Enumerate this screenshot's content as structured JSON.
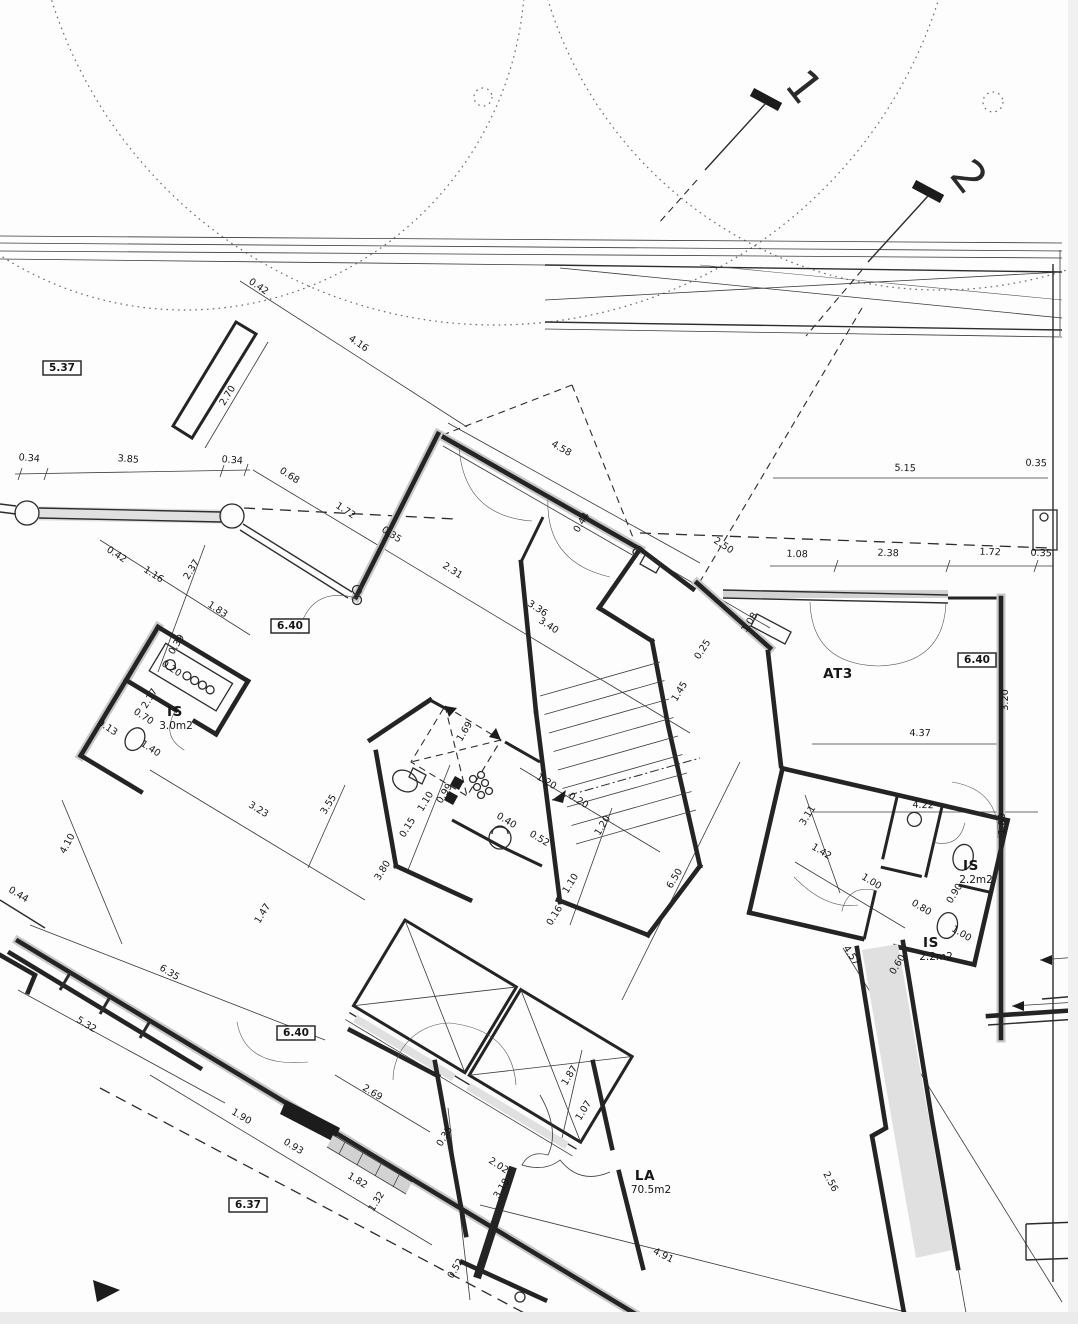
{
  "meta": {
    "kind": "architectural-floor-plan-scan",
    "units": "m"
  },
  "rooms": [
    {
      "name": "AT3",
      "area": ""
    },
    {
      "name": "IS",
      "area": "3.0m2"
    },
    {
      "name": "IS",
      "area": "2.2m2"
    },
    {
      "name": "IS",
      "area": "2.2m2"
    },
    {
      "name": "LA",
      "area": "70.5m2"
    }
  ],
  "elevation_marks": [
    "5.37",
    "6.40",
    "6.40",
    "6.40",
    "6.37"
  ],
  "section_markers": [
    "1",
    "2"
  ],
  "labels": [
    {
      "t": "1",
      "x": 792,
      "y": 96,
      "r": 52,
      "s": "big"
    },
    {
      "t": "2",
      "x": 957,
      "y": 186,
      "r": 52,
      "s": "big"
    },
    {
      "t": "0.42",
      "x": 257,
      "y": 289,
      "r": 34,
      "s": "dim"
    },
    {
      "t": "4.16",
      "x": 357,
      "y": 346,
      "r": 34,
      "s": "dim"
    },
    {
      "t": "2.70",
      "x": 230,
      "y": 397,
      "r": -58,
      "s": "dim"
    },
    {
      "t": "5.37",
      "x": 62,
      "y": 371,
      "r": 0,
      "s": "box"
    },
    {
      "t": "0.34",
      "x": 29,
      "y": 461,
      "r": 5,
      "s": "dim"
    },
    {
      "t": "3.85",
      "x": 128,
      "y": 462,
      "r": 5,
      "s": "dim"
    },
    {
      "t": "0.34",
      "x": 232,
      "y": 463,
      "r": 5,
      "s": "dim"
    },
    {
      "t": "0.68",
      "x": 288,
      "y": 478,
      "r": 33,
      "s": "dim"
    },
    {
      "t": "4.58",
      "x": 560,
      "y": 451,
      "r": 30,
      "s": "dim"
    },
    {
      "t": "1.72",
      "x": 344,
      "y": 513,
      "r": 33,
      "s": "dim"
    },
    {
      "t": "0.35",
      "x": 390,
      "y": 537,
      "r": 33,
      "s": "dim"
    },
    {
      "t": "2.31",
      "x": 451,
      "y": 573,
      "r": 33,
      "s": "dim"
    },
    {
      "t": "0.44",
      "x": 584,
      "y": 524,
      "r": -58,
      "s": "dim"
    },
    {
      "t": "2.50",
      "x": 722,
      "y": 548,
      "r": 33,
      "s": "dim"
    },
    {
      "t": "5.15",
      "x": 905,
      "y": 471,
      "r": 2,
      "s": "dim"
    },
    {
      "t": "0.35",
      "x": 1036,
      "y": 466,
      "r": 2,
      "s": "dim"
    },
    {
      "t": "1.08",
      "x": 797,
      "y": 557,
      "r": 2,
      "s": "dim"
    },
    {
      "t": "2.38",
      "x": 888,
      "y": 556,
      "r": 2,
      "s": "dim"
    },
    {
      "t": "1.72",
      "x": 990,
      "y": 555,
      "r": 2,
      "s": "dim"
    },
    {
      "t": "0.35",
      "x": 1041,
      "y": 556,
      "r": 2,
      "s": "dim"
    },
    {
      "t": "0.42",
      "x": 115,
      "y": 557,
      "r": 33,
      "s": "dim"
    },
    {
      "t": "1.16",
      "x": 152,
      "y": 577,
      "r": 33,
      "s": "dim"
    },
    {
      "t": "2.37",
      "x": 194,
      "y": 571,
      "r": -58,
      "s": "dim"
    },
    {
      "t": "1.83",
      "x": 216,
      "y": 612,
      "r": 33,
      "s": "dim"
    },
    {
      "t": "6.40",
      "x": 290,
      "y": 629,
      "r": 0,
      "s": "box"
    },
    {
      "t": "6.40",
      "x": 977,
      "y": 663,
      "r": 0,
      "s": "box"
    },
    {
      "t": "3.36",
      "x": 536,
      "y": 611,
      "r": 33,
      "s": "dim"
    },
    {
      "t": "3.40",
      "x": 547,
      "y": 628,
      "r": 33,
      "s": "dim"
    },
    {
      "t": "1.08",
      "x": 752,
      "y": 624,
      "r": -57,
      "s": "dim"
    },
    {
      "t": "0.25",
      "x": 705,
      "y": 651,
      "r": -57,
      "s": "dim"
    },
    {
      "t": "1.45",
      "x": 682,
      "y": 693,
      "r": -58,
      "s": "dim"
    },
    {
      "t": "AT3",
      "x": 838,
      "y": 678,
      "r": 0,
      "s": "room"
    },
    {
      "t": "3.20",
      "x": 1008,
      "y": 700,
      "r": -90,
      "s": "dim"
    },
    {
      "t": "4.37",
      "x": 920,
      "y": 736,
      "r": 1,
      "s": "dim"
    },
    {
      "t": "0.39",
      "x": 179,
      "y": 646,
      "r": -58,
      "s": "dim"
    },
    {
      "t": "0.20",
      "x": 170,
      "y": 671,
      "r": 33,
      "s": "dim"
    },
    {
      "t": "2.17",
      "x": 152,
      "y": 700,
      "r": -58,
      "s": "dim"
    },
    {
      "t": "IS",
      "x": 175,
      "y": 716,
      "r": 0,
      "s": "room"
    },
    {
      "t": "3.0m2",
      "x": 176,
      "y": 729,
      "r": 0,
      "s": "sub"
    },
    {
      "t": "0.70",
      "x": 142,
      "y": 719,
      "r": 33,
      "s": "dim"
    },
    {
      "t": "1.40",
      "x": 149,
      "y": 751,
      "r": 33,
      "s": "dim"
    },
    {
      "t": "0.13",
      "x": 106,
      "y": 730,
      "r": 33,
      "s": "dim"
    },
    {
      "t": "1.69",
      "x": 467,
      "y": 733,
      "r": -58,
      "s": "dim"
    },
    {
      "t": "0.99",
      "x": 447,
      "y": 795,
      "r": -58,
      "s": "dim"
    },
    {
      "t": "1.10",
      "x": 428,
      "y": 803,
      "r": -58,
      "s": "dim"
    },
    {
      "t": "0.15",
      "x": 410,
      "y": 829,
      "r": -58,
      "s": "dim"
    },
    {
      "t": "3.80",
      "x": 385,
      "y": 872,
      "r": -58,
      "s": "dim"
    },
    {
      "t": "1.20",
      "x": 545,
      "y": 784,
      "r": 31,
      "s": "dim"
    },
    {
      "t": "0.20",
      "x": 577,
      "y": 803,
      "r": 31,
      "s": "dim"
    },
    {
      "t": "1.20",
      "x": 605,
      "y": 827,
      "r": -58,
      "s": "dim"
    },
    {
      "t": "0.40",
      "x": 505,
      "y": 823,
      "r": 31,
      "s": "dim"
    },
    {
      "t": "0.52",
      "x": 538,
      "y": 841,
      "r": 31,
      "s": "dim"
    },
    {
      "t": "1.10",
      "x": 573,
      "y": 885,
      "r": -58,
      "s": "dim"
    },
    {
      "t": "0.16",
      "x": 557,
      "y": 917,
      "r": -58,
      "s": "dim"
    },
    {
      "t": "6.50",
      "x": 677,
      "y": 880,
      "r": -58,
      "s": "dim"
    },
    {
      "t": "3.23",
      "x": 257,
      "y": 812,
      "r": 31,
      "s": "dim"
    },
    {
      "t": "3.55",
      "x": 331,
      "y": 806,
      "r": -58,
      "s": "dim"
    },
    {
      "t": "4.10",
      "x": 70,
      "y": 845,
      "r": -62,
      "s": "dim"
    },
    {
      "t": "0.44",
      "x": 17,
      "y": 897,
      "r": 31,
      "s": "dim"
    },
    {
      "t": "1.47",
      "x": 265,
      "y": 915,
      "r": -58,
      "s": "dim"
    },
    {
      "t": "3.11",
      "x": 810,
      "y": 817,
      "r": -58,
      "s": "dim"
    },
    {
      "t": "4.22",
      "x": 923,
      "y": 808,
      "r": 2,
      "s": "dim"
    },
    {
      "t": "1.42",
      "x": 820,
      "y": 854,
      "r": 31,
      "s": "dim"
    },
    {
      "t": "1.80",
      "x": 1005,
      "y": 824,
      "r": -90,
      "s": "dim"
    },
    {
      "t": "1.00",
      "x": 870,
      "y": 884,
      "r": 31,
      "s": "dim"
    },
    {
      "t": "IS",
      "x": 971,
      "y": 870,
      "r": 0,
      "s": "room"
    },
    {
      "t": "2.2m2",
      "x": 976,
      "y": 883,
      "r": 0,
      "s": "sub"
    },
    {
      "t": "0.80",
      "x": 920,
      "y": 910,
      "r": 31,
      "s": "dim"
    },
    {
      "t": "0.90",
      "x": 957,
      "y": 895,
      "r": -58,
      "s": "dim"
    },
    {
      "t": "1.00",
      "x": 960,
      "y": 936,
      "r": 31,
      "s": "dim"
    },
    {
      "t": "IS",
      "x": 931,
      "y": 947,
      "r": 0,
      "s": "room"
    },
    {
      "t": "2.2m2",
      "x": 936,
      "y": 960,
      "r": 0,
      "s": "sub"
    },
    {
      "t": "0.60",
      "x": 900,
      "y": 966,
      "r": -58,
      "s": "dim"
    },
    {
      "t": "4.57",
      "x": 849,
      "y": 957,
      "r": 57,
      "s": "dim"
    },
    {
      "t": "2.56",
      "x": 828,
      "y": 1183,
      "r": 62,
      "s": "dim"
    },
    {
      "t": "6.35",
      "x": 168,
      "y": 975,
      "r": 31,
      "s": "dim"
    },
    {
      "t": "5.32",
      "x": 85,
      "y": 1027,
      "r": 31,
      "s": "dim"
    },
    {
      "t": "6.40",
      "x": 296,
      "y": 1036,
      "r": 0,
      "s": "box"
    },
    {
      "t": "2.69",
      "x": 371,
      "y": 1095,
      "r": 31,
      "s": "dim"
    },
    {
      "t": "1.90",
      "x": 240,
      "y": 1119,
      "r": 31,
      "s": "dim"
    },
    {
      "t": "0.93",
      "x": 292,
      "y": 1149,
      "r": 31,
      "s": "dim"
    },
    {
      "t": "1.82",
      "x": 356,
      "y": 1183,
      "r": 31,
      "s": "dim"
    },
    {
      "t": "1.32",
      "x": 379,
      "y": 1203,
      "r": -58,
      "s": "dim"
    },
    {
      "t": "6.37",
      "x": 248,
      "y": 1208,
      "r": 0,
      "s": "box"
    },
    {
      "t": "0.35",
      "x": 447,
      "y": 1138,
      "r": -58,
      "s": "dim"
    },
    {
      "t": "2.02",
      "x": 497,
      "y": 1168,
      "r": 33,
      "s": "dim"
    },
    {
      "t": "3.18",
      "x": 504,
      "y": 1190,
      "r": -58,
      "s": "dim"
    },
    {
      "t": "0.52",
      "x": 458,
      "y": 1270,
      "r": -58,
      "s": "dim"
    },
    {
      "t": "1.87",
      "x": 572,
      "y": 1077,
      "r": -58,
      "s": "dim"
    },
    {
      "t": "1.07",
      "x": 586,
      "y": 1112,
      "r": -58,
      "s": "dim"
    },
    {
      "t": "LA",
      "x": 645,
      "y": 1180,
      "r": 0,
      "s": "room"
    },
    {
      "t": "70.5m2",
      "x": 651,
      "y": 1193,
      "r": 0,
      "s": "sub"
    },
    {
      "t": "4.91",
      "x": 662,
      "y": 1258,
      "r": 27,
      "s": "dim"
    }
  ]
}
